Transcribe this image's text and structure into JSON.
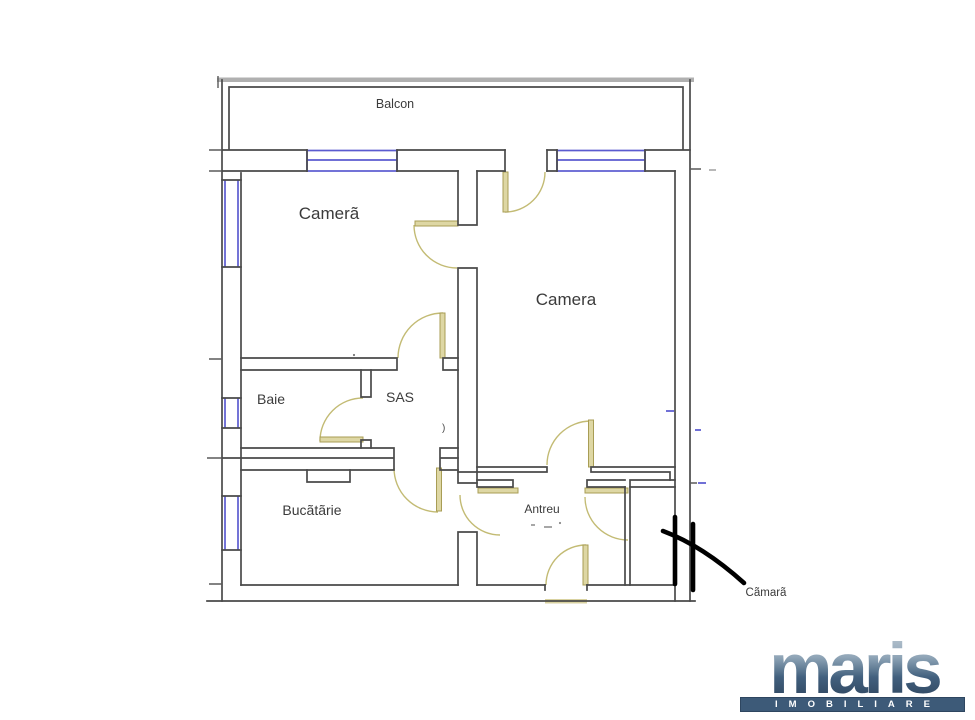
{
  "plan": {
    "rooms": {
      "balcon": {
        "label": "Balcon"
      },
      "camera_left": {
        "label": "Camerã"
      },
      "camera_right": {
        "label": "Camera"
      },
      "baie": {
        "label": "Baie"
      },
      "sas": {
        "label": "SAS"
      },
      "bucatarie": {
        "label": "Bucãtãrie"
      },
      "antreu": {
        "label": "Antreu"
      },
      "camara": {
        "label": "Cãmarã"
      }
    },
    "artifact_mark": ")"
  },
  "logo": {
    "brand": "maris",
    "subtitle": "IMOBILIARE"
  },
  "colors": {
    "wall": "#4a4a4a",
    "window": "#5b5bd0",
    "door_leaf_fill": "#ded7a4",
    "door_leaf_edge": "#a89d55",
    "door_arc": "#c3bb74",
    "balcony_edge": "#b0b0b0",
    "annotation": "#000000",
    "logo_bar": "#3d5a78",
    "logo_text": "#ffffff"
  }
}
